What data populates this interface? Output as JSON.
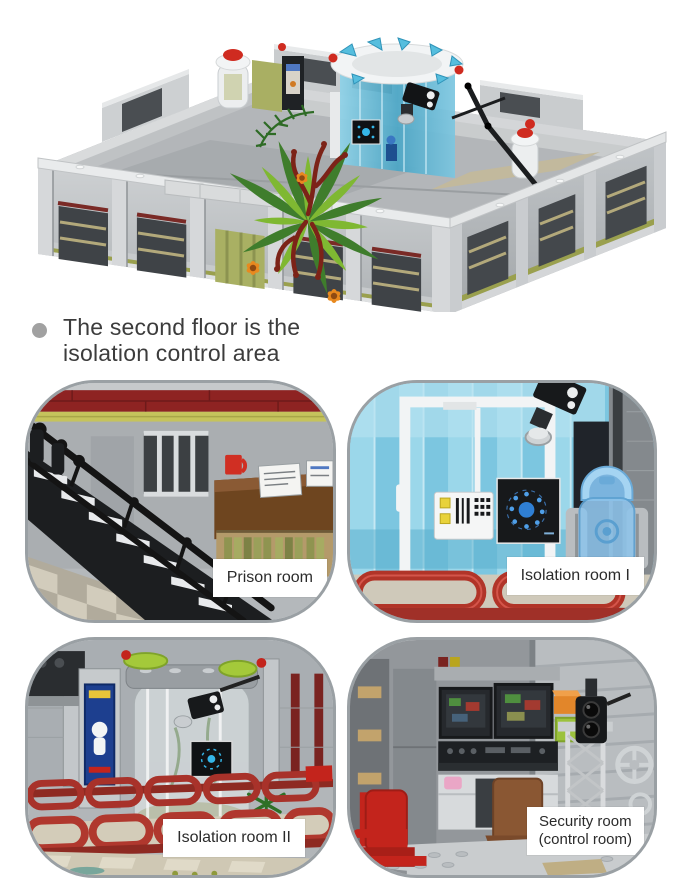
{
  "headline": {
    "text_line1": "The second floor is the",
    "text_line2": "isolation control area"
  },
  "panels": [
    {
      "label": "Prison room"
    },
    {
      "label": "Isolation room I"
    },
    {
      "label": "Isolation room II"
    },
    {
      "label": "Security room",
      "label_line2": "(control room)"
    }
  ],
  "colors": {
    "background": "#ffffff",
    "bullet": "#a1a1a1",
    "headline_text": "#3c3c3c",
    "panel_border": "#9aa0a4",
    "label_background": "#ffffff",
    "label_text": "#2b2b2b",
    "brick_light_gray": "#c6c9cb",
    "brick_dark_gray": "#8f9497",
    "glass_blue": "#7cc6e0",
    "railing_red": "#a93228",
    "roof_dark_red": "#8e2322",
    "accent_olive": "#c5c35c",
    "plant_lime": "#7fb832",
    "plant_dark_green": "#3f7d2c",
    "coral_dark_red": "#7c2318",
    "flower_orange": "#e8891f"
  }
}
